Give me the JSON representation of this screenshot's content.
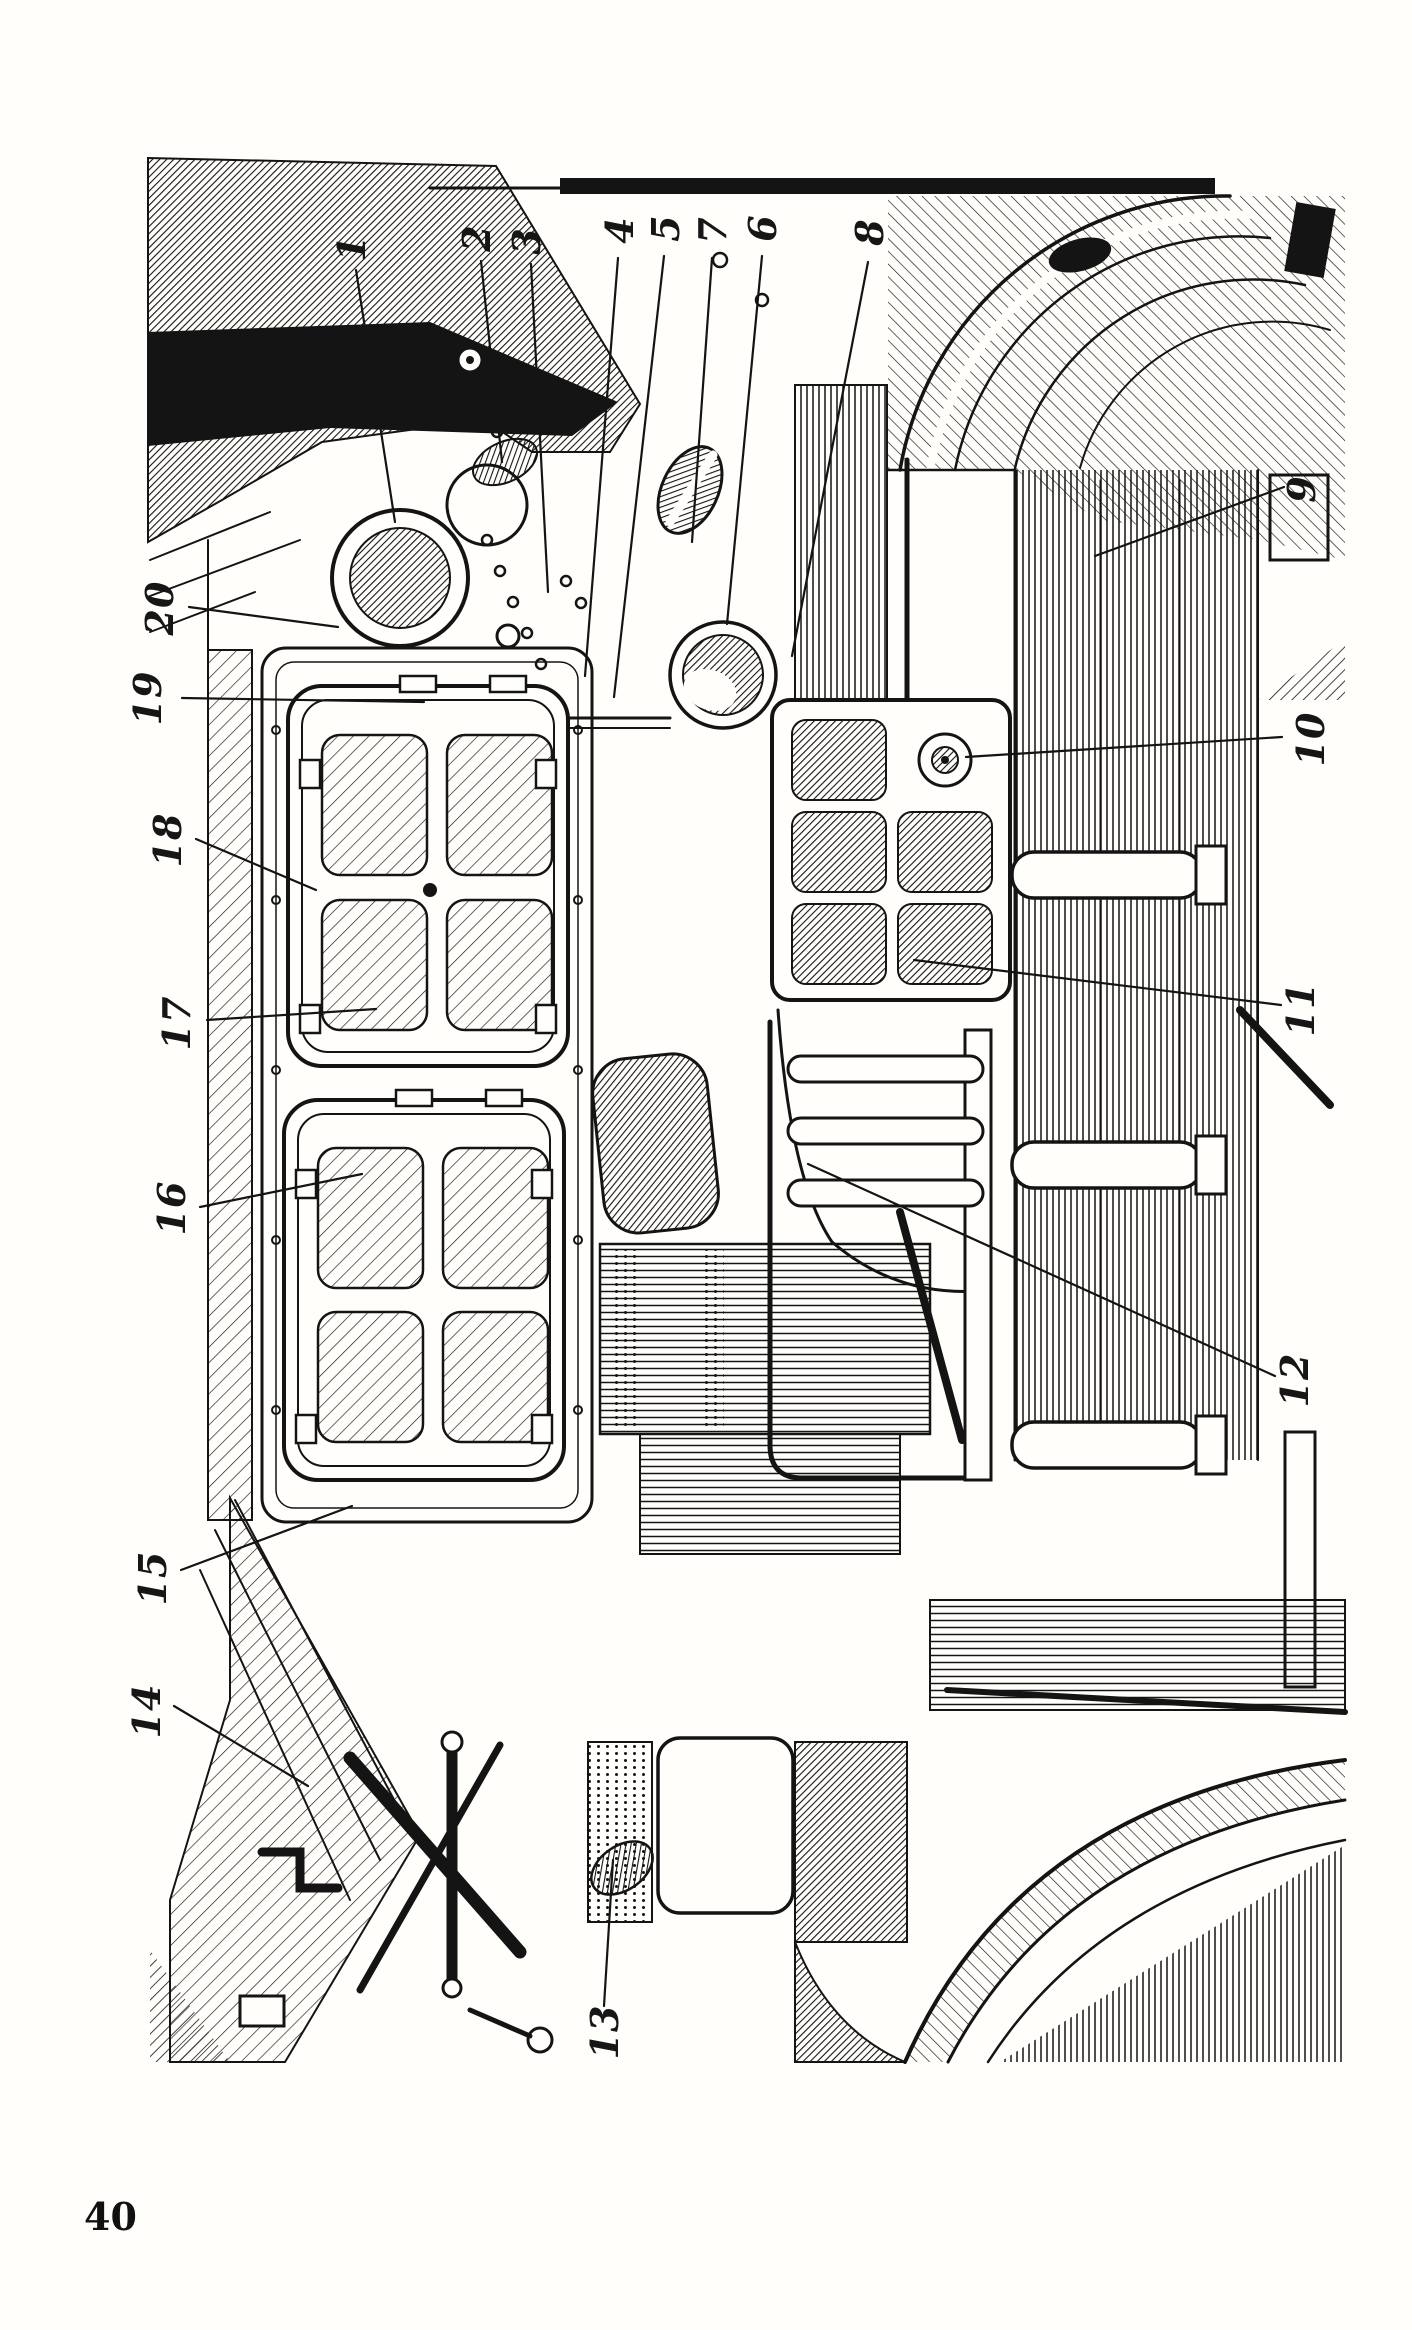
{
  "page": {
    "number": "40"
  },
  "figure": {
    "callouts": [
      {
        "label": "1"
      },
      {
        "label": "2"
      },
      {
        "label": "3"
      },
      {
        "label": "4"
      },
      {
        "label": "5"
      },
      {
        "label": "6"
      },
      {
        "label": "7"
      },
      {
        "label": "8"
      },
      {
        "label": "9"
      },
      {
        "label": "10"
      },
      {
        "label": "11"
      },
      {
        "label": "12"
      },
      {
        "label": "13"
      },
      {
        "label": "14"
      },
      {
        "label": "15"
      },
      {
        "label": "16"
      },
      {
        "label": "17"
      },
      {
        "label": "18"
      },
      {
        "label": "19"
      },
      {
        "label": "20"
      }
    ]
  }
}
